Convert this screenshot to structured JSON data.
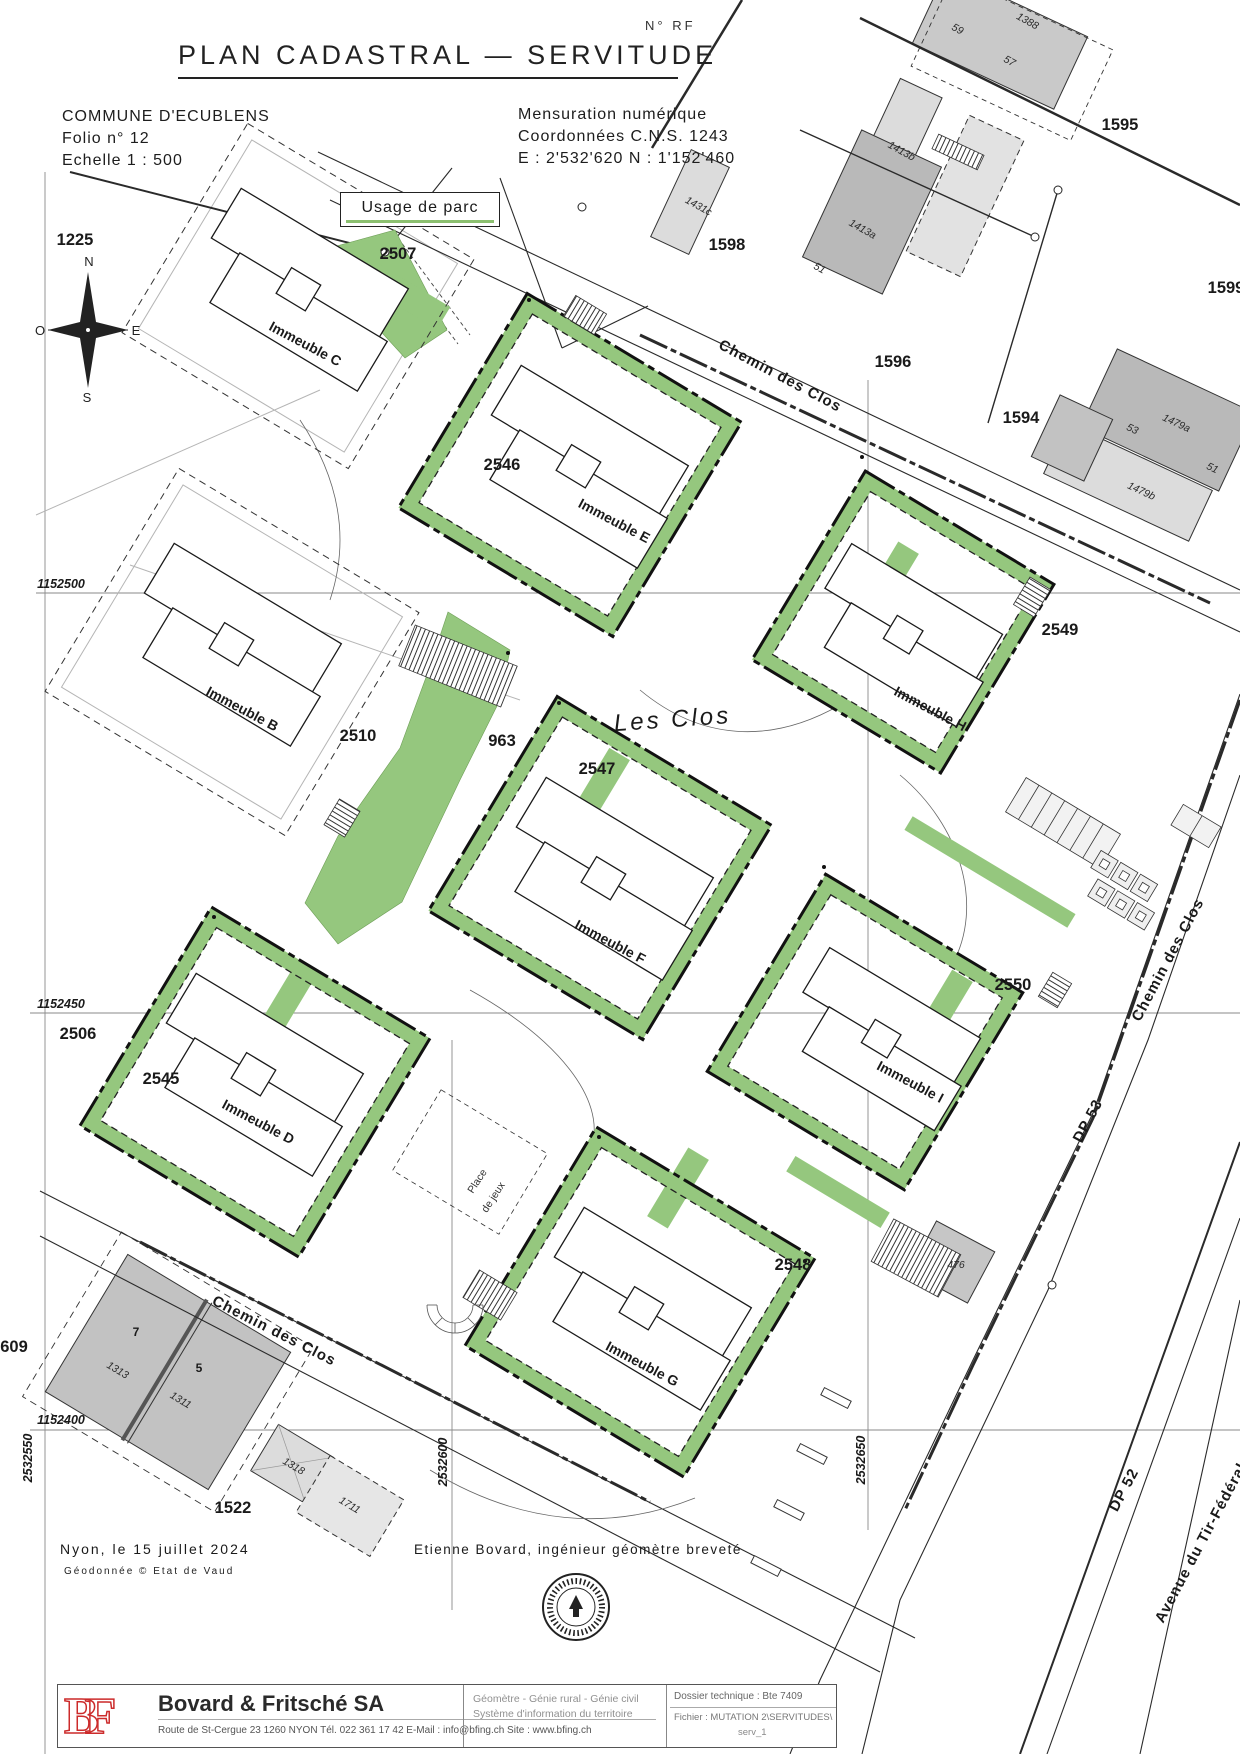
{
  "header": {
    "title": "PLAN  CADASTRAL  —  SERVITUDE",
    "no_rf": "N° RF",
    "commune": "COMMUNE D'ECUBLENS",
    "folio": "Folio n° 12",
    "echelle": "Echelle 1 : 500",
    "mensuration": "Mensuration numérique",
    "coordonnees": "Coordonnées C.N.S. 1243",
    "coords_en": "E : 2'532'620     N : 1'152'460"
  },
  "legend": {
    "label": "Usage de parc",
    "green": "#8cc070"
  },
  "compass": {
    "n": "N",
    "o": "O",
    "e": "E",
    "s": "S"
  },
  "map": {
    "labels": [
      {
        "t": "1225",
        "x": 75,
        "y": 245,
        "r": 0,
        "c": "parcel"
      },
      {
        "t": "2507",
        "x": 398,
        "y": 259,
        "r": 0,
        "c": "parcel"
      },
      {
        "t": "1598",
        "x": 727,
        "y": 250,
        "r": 0,
        "c": "parcel"
      },
      {
        "t": "1596",
        "x": 893,
        "y": 367,
        "r": 0,
        "c": "parcel"
      },
      {
        "t": "1595",
        "x": 1120,
        "y": 130,
        "r": 0,
        "c": "parcel"
      },
      {
        "t": "1594",
        "x": 1021,
        "y": 423,
        "r": 0,
        "c": "parcel"
      },
      {
        "t": "1599",
        "x": 1226,
        "y": 293,
        "r": 0,
        "c": "parcel"
      },
      {
        "t": "2546",
        "x": 502,
        "y": 470,
        "r": 0,
        "c": "parcel"
      },
      {
        "t": "2549",
        "x": 1060,
        "y": 635,
        "r": 0,
        "c": "parcel"
      },
      {
        "t": "2510",
        "x": 358,
        "y": 741,
        "r": 0,
        "c": "parcel"
      },
      {
        "t": "963",
        "x": 502,
        "y": 746,
        "r": 0,
        "c": "parcel"
      },
      {
        "t": "2547",
        "x": 597,
        "y": 774,
        "r": 0,
        "c": "parcel"
      },
      {
        "t": "2506",
        "x": 78,
        "y": 1039,
        "r": 0,
        "c": "parcel"
      },
      {
        "t": "2545",
        "x": 161,
        "y": 1084,
        "r": 0,
        "c": "parcel"
      },
      {
        "t": "2550",
        "x": 1013,
        "y": 990,
        "r": 0,
        "c": "parcel"
      },
      {
        "t": "2548",
        "x": 793,
        "y": 1270,
        "r": 0,
        "c": "parcel"
      },
      {
        "t": "1522",
        "x": 233,
        "y": 1513,
        "r": 0,
        "c": "parcel"
      },
      {
        "t": "609",
        "x": 14,
        "y": 1352,
        "r": 0,
        "c": "parcel"
      },
      {
        "t": "Immeuble C",
        "x": 303,
        "y": 348,
        "r": 28,
        "c": "building"
      },
      {
        "t": "Immeuble E",
        "x": 612,
        "y": 525,
        "r": 28,
        "c": "building"
      },
      {
        "t": "Immeuble B",
        "x": 240,
        "y": 713,
        "r": 28,
        "c": "building"
      },
      {
        "t": "Immeuble H",
        "x": 928,
        "y": 713,
        "r": 28,
        "c": "building"
      },
      {
        "t": "Immeuble F",
        "x": 608,
        "y": 946,
        "r": 28,
        "c": "building"
      },
      {
        "t": "Immeuble D",
        "x": 256,
        "y": 1126,
        "r": 28,
        "c": "building"
      },
      {
        "t": "Immeuble I",
        "x": 908,
        "y": 1086,
        "r": 28,
        "c": "building"
      },
      {
        "t": "Immeuble G",
        "x": 640,
        "y": 1368,
        "r": 28,
        "c": "building"
      },
      {
        "t": "Chemin des Clos",
        "x": 778,
        "y": 380,
        "r": 28,
        "c": "road"
      },
      {
        "t": "Chemin des Clos",
        "x": 272,
        "y": 1335,
        "r": 27,
        "c": "road"
      },
      {
        "t": "Chemin des Clos",
        "x": 1172,
        "y": 962,
        "r": -62,
        "c": "road"
      },
      {
        "t": "DP 53",
        "x": 1092,
        "y": 1123,
        "r": -62,
        "c": "road"
      },
      {
        "t": "DP 52",
        "x": 1128,
        "y": 1492,
        "r": -62,
        "c": "road"
      },
      {
        "t": "Avenue du Tir-Fédéral",
        "x": 1205,
        "y": 1545,
        "r": -62,
        "c": "road"
      },
      {
        "t": "Les Clos",
        "x": 673,
        "y": 727,
        "r": -4,
        "c": "lieu"
      },
      {
        "t": "1413b",
        "x": 900,
        "y": 154,
        "r": 29,
        "c": "small"
      },
      {
        "t": "1431c",
        "x": 697,
        "y": 209,
        "r": 29,
        "c": "small"
      },
      {
        "t": "1413a",
        "x": 861,
        "y": 232,
        "r": 29,
        "c": "small"
      },
      {
        "t": "51",
        "x": 818,
        "y": 271,
        "r": 29,
        "c": "small"
      },
      {
        "t": "1388",
        "x": 1026,
        "y": 24,
        "r": 29,
        "c": "small"
      },
      {
        "t": "59",
        "x": 956,
        "y": 32,
        "r": 29,
        "c": "small"
      },
      {
        "t": "57",
        "x": 1008,
        "y": 64,
        "r": 29,
        "c": "small"
      },
      {
        "t": "53",
        "x": 1131,
        "y": 432,
        "r": 25,
        "c": "small"
      },
      {
        "t": "1479a",
        "x": 1175,
        "y": 426,
        "r": 25,
        "c": "small"
      },
      {
        "t": "51",
        "x": 1211,
        "y": 471,
        "r": 25,
        "c": "small"
      },
      {
        "t": "1479b",
        "x": 1140,
        "y": 494,
        "r": 25,
        "c": "small"
      },
      {
        "t": "476",
        "x": 956,
        "y": 1268,
        "r": 0,
        "c": "small"
      },
      {
        "t": "1318",
        "x": 292,
        "y": 1469,
        "r": 31,
        "c": "small"
      },
      {
        "t": "1711",
        "x": 348,
        "y": 1508,
        "r": 31,
        "c": "small"
      },
      {
        "t": "1313",
        "x": 116,
        "y": 1373,
        "r": 31,
        "c": "small"
      },
      {
        "t": "1311",
        "x": 179,
        "y": 1403,
        "r": 31,
        "c": "small"
      },
      {
        "t": "7",
        "x": 136,
        "y": 1336,
        "r": 0,
        "c": "smallbold"
      },
      {
        "t": "5",
        "x": 199,
        "y": 1372,
        "r": 0,
        "c": "smallbold"
      },
      {
        "t": "1152500",
        "x": 61,
        "y": 588,
        "r": 0,
        "c": "grid"
      },
      {
        "t": "1152450",
        "x": 61,
        "y": 1008,
        "r": 0,
        "c": "grid"
      },
      {
        "t": "1152400",
        "x": 61,
        "y": 1424,
        "r": 0,
        "c": "grid"
      },
      {
        "t": "2532550",
        "x": 32,
        "y": 1458,
        "r": -90,
        "c": "grid"
      },
      {
        "t": "2532600",
        "x": 447,
        "y": 1462,
        "r": -90,
        "c": "grid"
      },
      {
        "t": "2532650",
        "x": 865,
        "y": 1460,
        "r": -90,
        "c": "grid"
      },
      {
        "t": "Place",
        "x": 480,
        "y": 1183,
        "r": -57,
        "c": "tiny"
      },
      {
        "t": "de jeux",
        "x": 496,
        "y": 1199,
        "r": -57,
        "c": "tiny"
      }
    ]
  },
  "footer": {
    "date_line": "Nyon, le 15 juillet 2024",
    "geodata": "Géodonnée © Etat de Vaud",
    "engineer": "Etienne Bovard, ingénieur géomètre breveté",
    "company": {
      "logo": "BF",
      "name": "Bovard & Fritsché SA",
      "services_1": "Géomètre - Génie rural - Génie civil",
      "services_2": "Système d'information du territoire",
      "address": "Route de St-Cergue 23    1260 NYON    Tél. 022 361 17 42    E-Mail : info@bfing.ch    Site : www.bfing.ch",
      "dossier": "Dossier technique : Bte 7409",
      "fichier": "Fichier :  MUTATION 2\\SERVITUDES\\",
      "fichier2": "serv_1"
    }
  }
}
